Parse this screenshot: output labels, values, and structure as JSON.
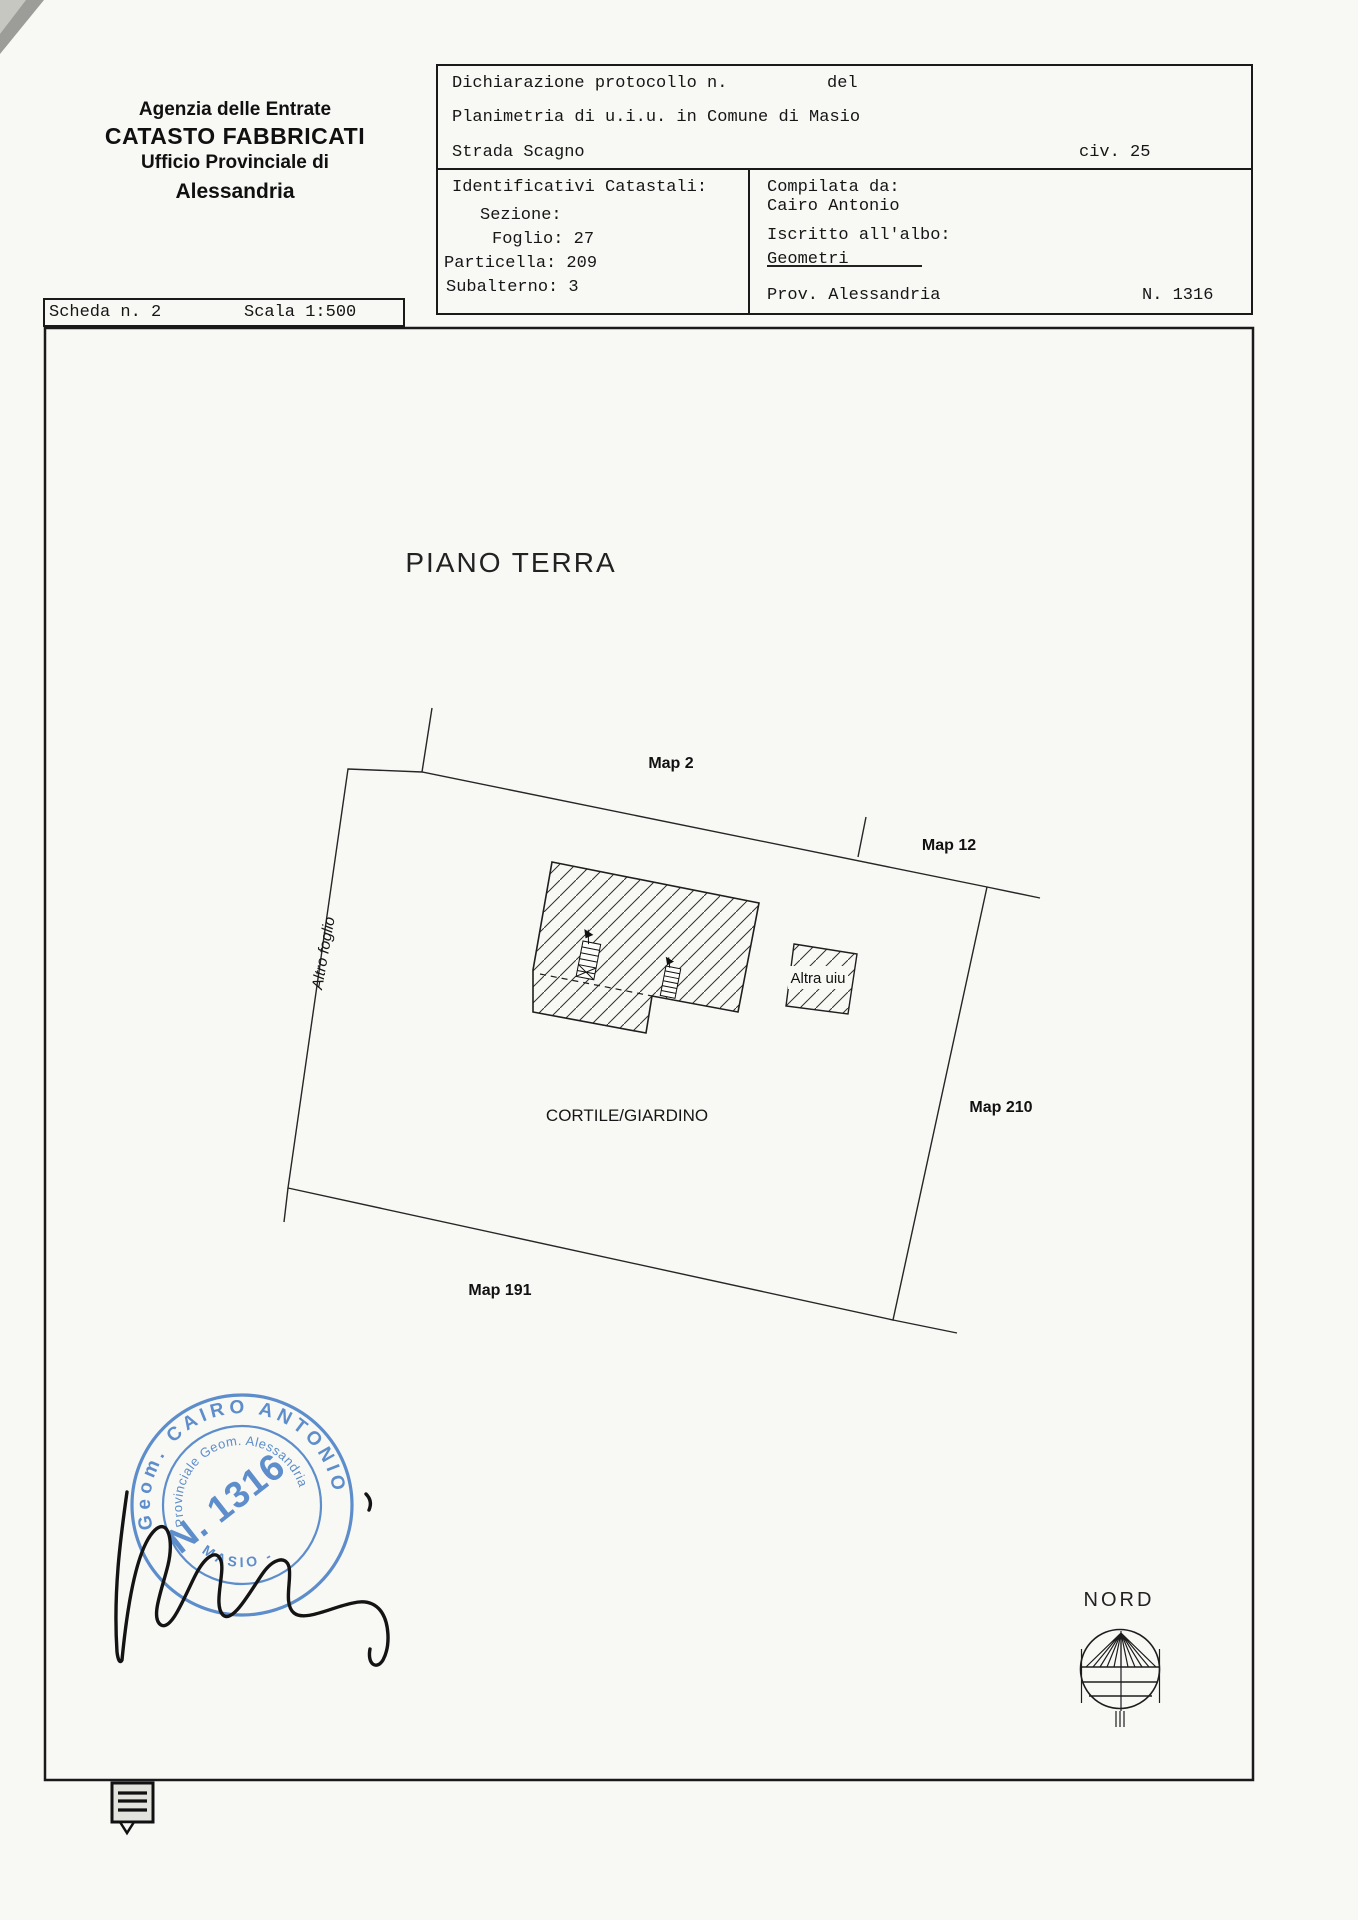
{
  "agency_header": {
    "line1": "Agenzia delle Entrate",
    "line2": "CATASTO FABBRICATI",
    "line3": "Ufficio Provinciale di",
    "line4": "Alessandria"
  },
  "declaration_box": {
    "protocol_label": "Dichiarazione protocollo n.",
    "del_label": "del",
    "planimetria": "Planimetria di u.i.u. in Comune di Masio",
    "street": "Strada Scagno",
    "civ": "civ. 25"
  },
  "catastali_box": {
    "title": "Identificativi Catastali:",
    "sezione": "Sezione:",
    "foglio": "Foglio: 27",
    "particella": "Particella: 209",
    "subalterno": "Subalterno: 3"
  },
  "compilata_box": {
    "title": "Compilata da:",
    "name": "Cairo Antonio",
    "albo_label": "Iscritto all'albo:",
    "albo_value": "Geometri",
    "prov": "Prov. Alessandria",
    "number": "N. 1316"
  },
  "scheda_box": {
    "scheda": "Scheda n. 2",
    "scala": "Scala 1:500"
  },
  "plan": {
    "title": "PIANO TERRA",
    "labels": {
      "map2": "Map 2",
      "map12": "Map 12",
      "map210": "Map 210",
      "map191": "Map 191",
      "cortile": "CORTILE/GIARDINO",
      "altro_foglio": "Altro foglio",
      "altra_uiu": "Altra uiu"
    }
  },
  "compass": {
    "label": "NORD"
  },
  "stamp": {
    "outer_text": "Geom. CAIRO ANTONIO",
    "inner_text": "Provinciale Geom. Alessandria",
    "bottom_text": "- MASIO -",
    "number": "N. 1316",
    "blue": "#4d82c6"
  }
}
